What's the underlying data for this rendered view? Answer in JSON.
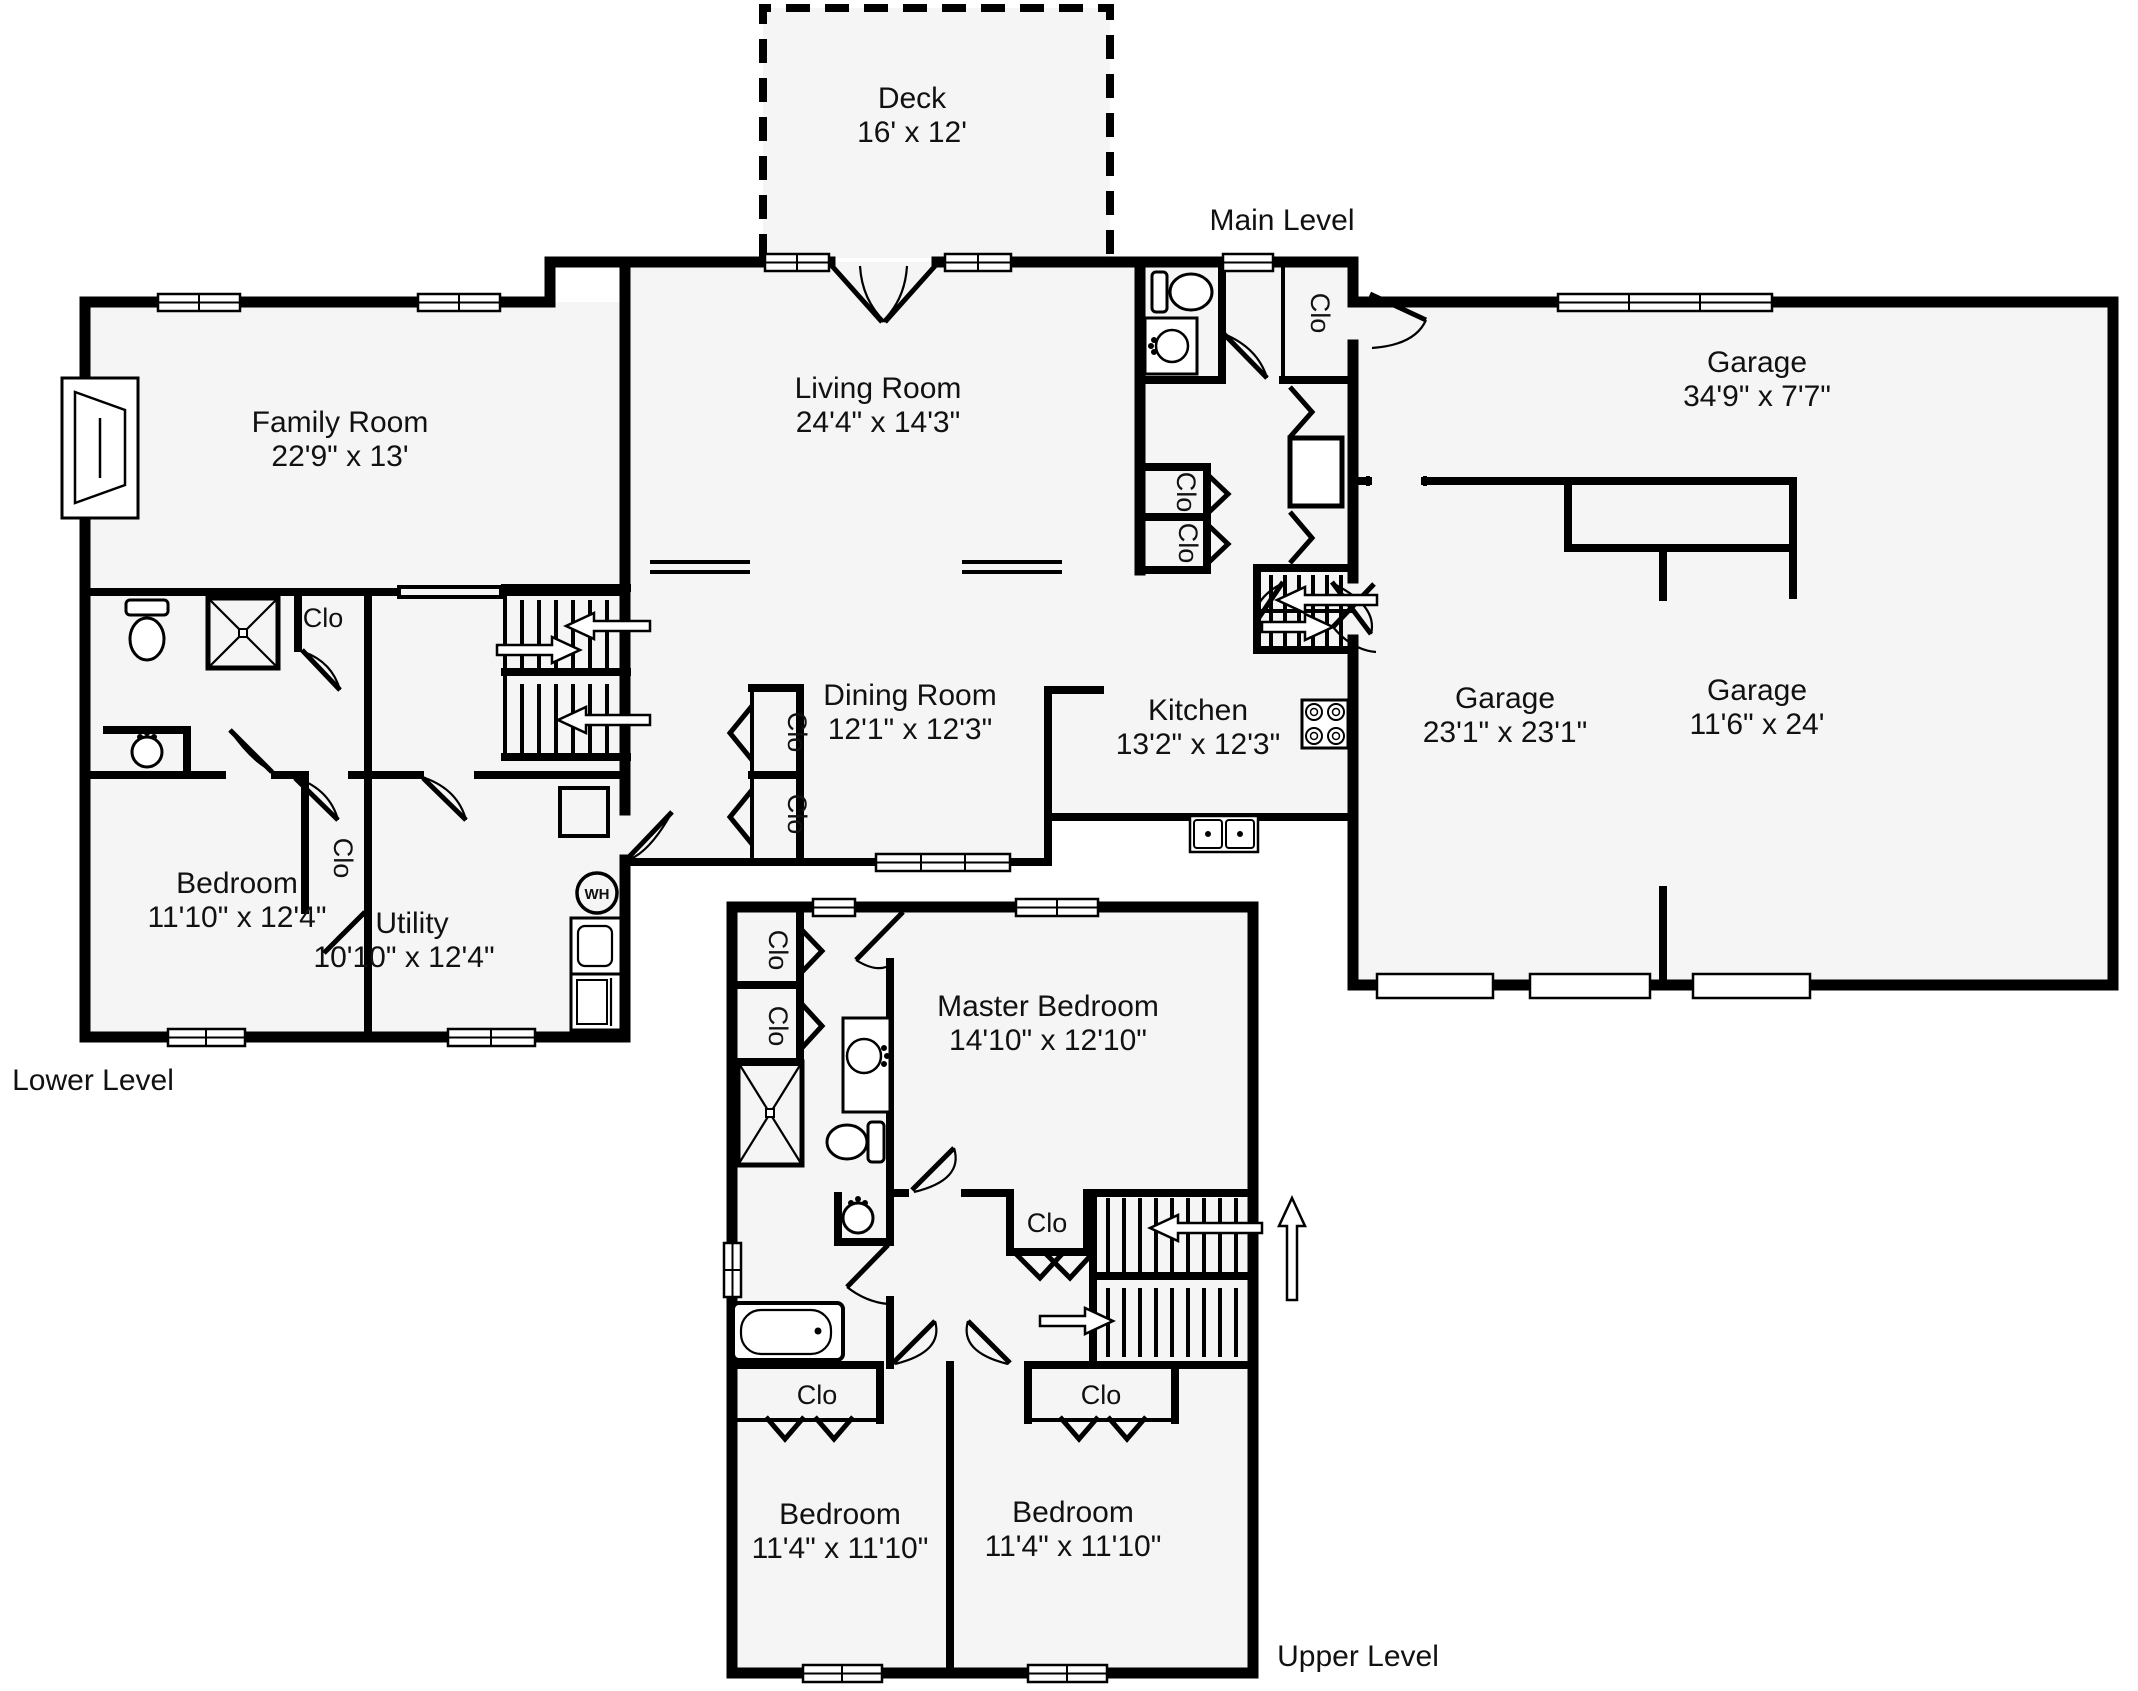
{
  "plan": {
    "background": "#ffffff",
    "floor_color": "#f5f5f5",
    "wall_color": "#000000"
  },
  "levels": [
    {
      "label": "Main Level"
    },
    {
      "label": "Lower Level"
    },
    {
      "label": "Upper Level"
    }
  ],
  "rooms": [
    {
      "name": "Deck",
      "dims": "16' x 12'"
    },
    {
      "name": "Living Room",
      "dims": "24'4\" x 14'3\""
    },
    {
      "name": "Family Room",
      "dims": "22'9\" x 13'"
    },
    {
      "name": "Garage",
      "dims": "34'9\" x 7'7\""
    },
    {
      "name": "Garage",
      "dims": "23'1\" x 23'1\""
    },
    {
      "name": "Garage",
      "dims": "11'6\" x 24'"
    },
    {
      "name": "Dining Room",
      "dims": "12'1\" x 12'3\""
    },
    {
      "name": "Kitchen",
      "dims": "13'2\" x 12'3\""
    },
    {
      "name": "Bedroom",
      "dims": "11'10\" x 12'4\""
    },
    {
      "name": "Utility",
      "dims": "10'10\" x 12'4\""
    },
    {
      "name": "Master Bedroom",
      "dims": "14'10\" x 12'10\""
    },
    {
      "name": "Bedroom",
      "dims": "11'4\" x 11'10\""
    },
    {
      "name": "Bedroom",
      "dims": "11'4\" x 11'10\""
    }
  ],
  "closets": [
    {
      "label": "Clo"
    },
    {
      "label": "Clo"
    },
    {
      "label": "Clo"
    },
    {
      "label": "Clo"
    },
    {
      "label": "Clo"
    },
    {
      "label": "Clo"
    },
    {
      "label": "Clo"
    },
    {
      "label": "Clo"
    },
    {
      "label": "Clo"
    },
    {
      "label": "Clo"
    },
    {
      "label": "Clo"
    },
    {
      "label": "Clo"
    }
  ],
  "fixtures": {
    "water_heater": "WH"
  }
}
